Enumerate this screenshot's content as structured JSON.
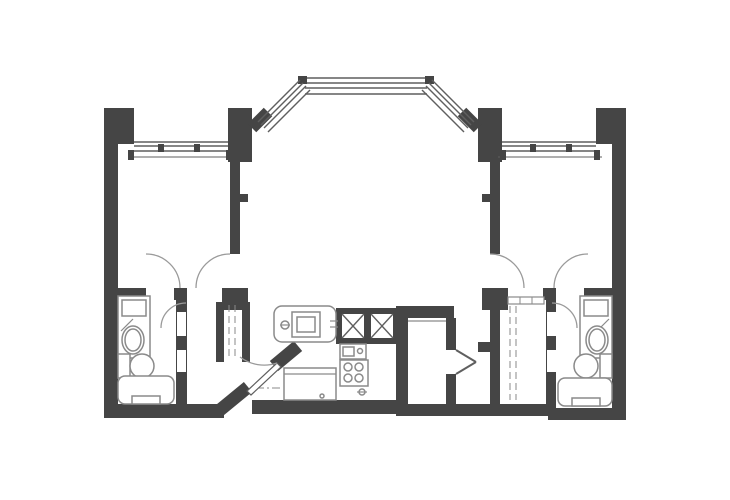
{
  "canvas": {
    "width": 730,
    "height": 500
  },
  "colors": {
    "wall": "#454545",
    "win": "#5f5f5f",
    "fix": "#8a8a8a",
    "arc": "#9a9a9a",
    "bg": "#ffffff"
  },
  "elements": [
    {
      "n": "left-outer-wall",
      "t": "w",
      "x": 104,
      "y": 108,
      "w": 14,
      "h": 310
    },
    {
      "n": "left-top-corner-block",
      "t": "w",
      "x": 104,
      "y": 108,
      "w": 30,
      "h": 34
    },
    {
      "n": "left-sill-stub",
      "t": "w",
      "x": 118,
      "y": 136,
      "w": 16,
      "h": 8
    },
    {
      "n": "bay-left-column",
      "t": "w",
      "x": 228,
      "y": 108,
      "w": 24,
      "h": 54
    },
    {
      "n": "bay-right-column",
      "t": "w",
      "x": 478,
      "y": 108,
      "w": 24,
      "h": 54
    },
    {
      "n": "right-sill-stub",
      "t": "w",
      "x": 596,
      "y": 136,
      "w": 16,
      "h": 8
    },
    {
      "n": "right-top-corner-block",
      "t": "w",
      "x": 596,
      "y": 108,
      "w": 30,
      "h": 34
    },
    {
      "n": "right-outer-wall",
      "t": "w",
      "x": 612,
      "y": 108,
      "w": 14,
      "h": 312
    },
    {
      "n": "left-divider-wall",
      "t": "w",
      "x": 230,
      "y": 162,
      "w": 10,
      "h": 92
    },
    {
      "n": "left-divider-stub",
      "t": "w",
      "x": 240,
      "y": 194,
      "w": 8,
      "h": 8
    },
    {
      "n": "right-divider-wall",
      "t": "w",
      "x": 490,
      "y": 162,
      "w": 10,
      "h": 92
    },
    {
      "n": "right-divider-stub",
      "t": "w",
      "x": 482,
      "y": 194,
      "w": 8,
      "h": 8
    },
    {
      "n": "left-bedroom-south-wall-west",
      "t": "w",
      "x": 118,
      "y": 288,
      "w": 28,
      "h": 12
    },
    {
      "n": "left-bedroom-south-wall-mid",
      "t": "w",
      "x": 174,
      "y": 288,
      "w": 13,
      "h": 12
    },
    {
      "n": "left-foyer-corner-block",
      "t": "w",
      "x": 222,
      "y": 288,
      "w": 26,
      "h": 22
    },
    {
      "n": "right-bedroom-south-wall-east",
      "t": "w",
      "x": 584,
      "y": 288,
      "w": 28,
      "h": 12
    },
    {
      "n": "right-bedroom-south-wall-mid",
      "t": "w",
      "x": 543,
      "y": 288,
      "w": 13,
      "h": 12
    },
    {
      "n": "right-foyer-corner-block",
      "t": "w",
      "x": 482,
      "y": 288,
      "w": 26,
      "h": 22
    },
    {
      "n": "left-bath-partition-wall",
      "t": "w",
      "x": 176,
      "y": 288,
      "w": 11,
      "h": 122
    },
    {
      "n": "left-bath-south-wall",
      "t": "w",
      "x": 104,
      "y": 404,
      "w": 86,
      "h": 14
    },
    {
      "n": "left-hall-south-wall",
      "t": "w",
      "x": 186,
      "y": 404,
      "w": 38,
      "h": 14
    },
    {
      "n": "left-closet-west-wall",
      "t": "w",
      "x": 216,
      "y": 302,
      "w": 8,
      "h": 60
    },
    {
      "n": "left-closet-east-wall",
      "t": "w",
      "x": 242,
      "y": 302,
      "w": 8,
      "h": 60
    },
    {
      "n": "shaft-enclosure",
      "t": "w",
      "x": 336,
      "y": 308,
      "w": 62,
      "h": 36
    },
    {
      "n": "kitchen-east-wall",
      "t": "w",
      "x": 396,
      "y": 306,
      "w": 12,
      "h": 108
    },
    {
      "n": "den-north-wall",
      "t": "w",
      "x": 408,
      "y": 306,
      "w": 46,
      "h": 12
    },
    {
      "n": "den-east-wall-upper",
      "t": "w",
      "x": 446,
      "y": 318,
      "w": 10,
      "h": 32
    },
    {
      "n": "den-east-wall-lower",
      "t": "w",
      "x": 446,
      "y": 374,
      "w": 10,
      "h": 40
    },
    {
      "n": "kitchen-south-wall",
      "t": "w",
      "x": 252,
      "y": 400,
      "w": 146,
      "h": 14
    },
    {
      "n": "center-south-wall",
      "t": "w",
      "x": 396,
      "y": 404,
      "w": 160,
      "h": 12
    },
    {
      "n": "right-closet-west-wall",
      "t": "w",
      "x": 490,
      "y": 310,
      "w": 10,
      "h": 94
    },
    {
      "n": "right-closet-west-stub",
      "t": "w",
      "x": 478,
      "y": 342,
      "w": 12,
      "h": 10
    },
    {
      "n": "right-bath-partition-wall",
      "t": "w",
      "x": 546,
      "y": 288,
      "w": 10,
      "h": 122
    },
    {
      "n": "right-bath-south-wall",
      "t": "w",
      "x": 548,
      "y": 408,
      "w": 78,
      "h": 12
    },
    {
      "n": "entry-diagonal-wall-lower",
      "t": "l",
      "x1": 220,
      "y1": 410,
      "x2": 248,
      "y2": 387,
      "c": "wall",
      "sw": 13
    },
    {
      "n": "entry-diagonal-wall-upper",
      "t": "l",
      "x1": 274,
      "y1": 366,
      "x2": 298,
      "y2": 346,
      "c": "wall",
      "sw": 13
    },
    {
      "n": "bay-left-wall-stub",
      "t": "l",
      "x1": 252,
      "y1": 128,
      "x2": 268,
      "y2": 112,
      "c": "wall",
      "sw": 12
    },
    {
      "n": "bay-right-wall-stub",
      "t": "l",
      "x1": 462,
      "y1": 112,
      "x2": 478,
      "y2": 128,
      "c": "wall",
      "sw": 12
    },
    {
      "n": "left-bath-door-jamb-upper",
      "t": "b",
      "x": 177,
      "y": 312,
      "w": 9,
      "h": 24
    },
    {
      "n": "left-bath-door-jamb-lower",
      "t": "b",
      "x": 177,
      "y": 350,
      "w": 9,
      "h": 22
    },
    {
      "n": "right-bath-door-jamb-upper",
      "t": "b",
      "x": 547,
      "y": 312,
      "w": 9,
      "h": 24
    },
    {
      "n": "right-bath-door-jamb-lower",
      "t": "b",
      "x": 547,
      "y": 350,
      "w": 9,
      "h": 22
    },
    {
      "n": "left-window-line-outer",
      "t": "l",
      "x1": 134,
      "y1": 142,
      "x2": 228,
      "y2": 142,
      "c": "win",
      "sw": 1.4
    },
    {
      "n": "left-window-line-mid",
      "t": "l",
      "x1": 134,
      "y1": 146,
      "x2": 228,
      "y2": 146,
      "c": "win",
      "sw": 1.4
    },
    {
      "n": "left-window-line-inner",
      "t": "l",
      "x1": 134,
      "y1": 151,
      "x2": 228,
      "y2": 151,
      "c": "win",
      "sw": 1.4
    },
    {
      "n": "left-window-sill",
      "t": "l",
      "x1": 128,
      "y1": 157,
      "x2": 232,
      "y2": 157,
      "c": "win",
      "sw": 1.1
    },
    {
      "n": "left-window-mullion-a",
      "t": "w",
      "x": 158,
      "y": 144,
      "w": 6,
      "h": 8
    },
    {
      "n": "left-window-mullion-b",
      "t": "w",
      "x": 194,
      "y": 144,
      "w": 6,
      "h": 8
    },
    {
      "n": "left-window-hook-west",
      "t": "w",
      "x": 128,
      "y": 150,
      "w": 6,
      "h": 10
    },
    {
      "n": "left-window-hook-east",
      "t": "w",
      "x": 226,
      "y": 150,
      "w": 6,
      "h": 10
    },
    {
      "n": "right-window-line-outer",
      "t": "l",
      "x1": 502,
      "y1": 142,
      "x2": 596,
      "y2": 142,
      "c": "win",
      "sw": 1.4
    },
    {
      "n": "right-window-line-mid",
      "t": "l",
      "x1": 502,
      "y1": 146,
      "x2": 596,
      "y2": 146,
      "c": "win",
      "sw": 1.4
    },
    {
      "n": "right-window-line-inner",
      "t": "l",
      "x1": 502,
      "y1": 151,
      "x2": 596,
      "y2": 151,
      "c": "win",
      "sw": 1.4
    },
    {
      "n": "right-window-sill",
      "t": "l",
      "x1": 498,
      "y1": 157,
      "x2": 602,
      "y2": 157,
      "c": "win",
      "sw": 1.1
    },
    {
      "n": "right-window-mullion-a",
      "t": "w",
      "x": 530,
      "y": 144,
      "w": 6,
      "h": 8
    },
    {
      "n": "right-window-mullion-b",
      "t": "w",
      "x": 566,
      "y": 144,
      "w": 6,
      "h": 8
    },
    {
      "n": "right-window-hook-west",
      "t": "w",
      "x": 500,
      "y": 150,
      "w": 6,
      "h": 10
    },
    {
      "n": "right-window-hook-east",
      "t": "w",
      "x": 594,
      "y": 150,
      "w": 6,
      "h": 10
    },
    {
      "n": "bay-top-window-line-1",
      "t": "l",
      "x1": 305,
      "y1": 78,
      "x2": 427,
      "y2": 78,
      "c": "win",
      "sw": 1.4
    },
    {
      "n": "bay-top-window-line-2",
      "t": "l",
      "x1": 305,
      "y1": 83,
      "x2": 427,
      "y2": 83,
      "c": "win",
      "sw": 1.4
    },
    {
      "n": "bay-top-window-line-3",
      "t": "l",
      "x1": 305,
      "y1": 88,
      "x2": 427,
      "y2": 88,
      "c": "win",
      "sw": 1.4
    },
    {
      "n": "bay-top-window-line-4",
      "t": "l",
      "x1": 305,
      "y1": 94,
      "x2": 427,
      "y2": 94,
      "c": "win",
      "sw": 1.4
    },
    {
      "n": "bay-mullion-left",
      "t": "w",
      "x": 298,
      "y": 76,
      "w": 9,
      "h": 8
    },
    {
      "n": "bay-mullion-right",
      "t": "w",
      "x": 425,
      "y": 76,
      "w": 9,
      "h": 8
    },
    {
      "n": "bay-left-window-line-1",
      "t": "l",
      "x1": 258,
      "y1": 122,
      "x2": 300,
      "y2": 80,
      "c": "win",
      "sw": 1.4
    },
    {
      "n": "bay-left-window-line-2",
      "t": "l",
      "x1": 261,
      "y1": 125,
      "x2": 303,
      "y2": 83,
      "c": "win",
      "sw": 1.4
    },
    {
      "n": "bay-left-window-line-3",
      "t": "l",
      "x1": 264,
      "y1": 128,
      "x2": 306,
      "y2": 86,
      "c": "win",
      "sw": 1.4
    },
    {
      "n": "bay-left-window-line-4",
      "t": "l",
      "x1": 268,
      "y1": 132,
      "x2": 310,
      "y2": 90,
      "c": "win",
      "sw": 1.4
    },
    {
      "n": "bay-right-window-line-1",
      "t": "l",
      "x1": 432,
      "y1": 80,
      "x2": 474,
      "y2": 122,
      "c": "win",
      "sw": 1.4
    },
    {
      "n": "bay-right-window-line-2",
      "t": "l",
      "x1": 429,
      "y1": 83,
      "x2": 471,
      "y2": 125,
      "c": "win",
      "sw": 1.4
    },
    {
      "n": "bay-right-window-line-3",
      "t": "l",
      "x1": 426,
      "y1": 86,
      "x2": 468,
      "y2": 128,
      "c": "win",
      "sw": 1.4
    },
    {
      "n": "bay-right-window-line-4",
      "t": "l",
      "x1": 422,
      "y1": 90,
      "x2": 464,
      "y2": 132,
      "c": "win",
      "sw": 1.4
    },
    {
      "n": "left-vanity-counter",
      "t": "o",
      "x": 118,
      "y": 296,
      "w": 32,
      "h": 62
    },
    {
      "n": "left-vanity-shelf",
      "t": "o",
      "x": 122,
      "y": 300,
      "w": 24,
      "h": 16
    },
    {
      "n": "left-vanity-hatch",
      "t": "l",
      "x1": 121,
      "y1": 331,
      "x2": 133,
      "y2": 319,
      "c": "fix",
      "sw": 1.2
    },
    {
      "n": "left-sink-outer",
      "t": "e",
      "cx": 133,
      "cy": 340,
      "rx": 11,
      "ry": 14
    },
    {
      "n": "left-sink-inner",
      "t": "e",
      "cx": 133,
      "cy": 340,
      "rx": 8,
      "ry": 11
    },
    {
      "n": "left-toilet-tank",
      "t": "o",
      "x": 118,
      "y": 354,
      "w": 12,
      "h": 24
    },
    {
      "n": "left-toilet-bowl",
      "t": "c",
      "cx": 142,
      "cy": 366,
      "r": 12
    },
    {
      "n": "left-bathtub",
      "t": "o",
      "x": 118,
      "y": 376,
      "w": 56,
      "h": 28,
      "rx": 7
    },
    {
      "n": "left-bathtub-detail",
      "t": "o",
      "x": 132,
      "y": 396,
      "w": 28,
      "h": 8
    },
    {
      "n": "right-vanity-counter",
      "t": "o",
      "x": 580,
      "y": 296,
      "w": 32,
      "h": 62
    },
    {
      "n": "right-vanity-shelf",
      "t": "o",
      "x": 584,
      "y": 300,
      "w": 24,
      "h": 16
    },
    {
      "n": "right-vanity-hatch",
      "t": "l",
      "x1": 597,
      "y1": 331,
      "x2": 609,
      "y2": 319,
      "c": "fix",
      "sw": 1.2
    },
    {
      "n": "right-sink-outer",
      "t": "e",
      "cx": 597,
      "cy": 340,
      "rx": 11,
      "ry": 14
    },
    {
      "n": "right-sink-inner",
      "t": "e",
      "cx": 597,
      "cy": 340,
      "rx": 8,
      "ry": 11
    },
    {
      "n": "right-toilet-tank",
      "t": "o",
      "x": 600,
      "y": 354,
      "w": 12,
      "h": 24
    },
    {
      "n": "right-toilet-bowl",
      "t": "c",
      "cx": 586,
      "cy": 366,
      "r": 12
    },
    {
      "n": "right-bathtub",
      "t": "o",
      "x": 558,
      "y": 378,
      "w": 54,
      "h": 28,
      "rx": 7
    },
    {
      "n": "right-bathtub-detail",
      "t": "o",
      "x": 572,
      "y": 398,
      "w": 28,
      "h": 8
    },
    {
      "n": "left-closet-rod-line-a",
      "t": "l",
      "x1": 229,
      "y1": 305,
      "x2": 229,
      "y2": 360,
      "c": "fix",
      "sw": 1,
      "dash": "7,4"
    },
    {
      "n": "left-closet-rod-line-b",
      "t": "l",
      "x1": 235,
      "y1": 305,
      "x2": 235,
      "y2": 360,
      "c": "fix",
      "sw": 1,
      "dash": "7,4"
    },
    {
      "n": "right-closet-rod-line-a",
      "t": "l",
      "x1": 510,
      "y1": 306,
      "x2": 510,
      "y2": 400,
      "c": "fix",
      "sw": 1,
      "dash": "7,4"
    },
    {
      "n": "right-closet-rod-line-b",
      "t": "l",
      "x1": 516,
      "y1": 306,
      "x2": 516,
      "y2": 400,
      "c": "fix",
      "sw": 1,
      "dash": "7,4"
    },
    {
      "n": "right-closet-door-track",
      "t": "o",
      "x": 508,
      "y": 297,
      "w": 36,
      "h": 7,
      "sw": 1.2
    },
    {
      "n": "right-closet-track-tick-a",
      "t": "l",
      "x1": 520,
      "y1": 297,
      "x2": 520,
      "y2": 304,
      "c": "fix",
      "sw": 1
    },
    {
      "n": "right-closet-track-tick-b",
      "t": "l",
      "x1": 532,
      "y1": 297,
      "x2": 532,
      "y2": 304,
      "c": "fix",
      "sw": 1
    },
    {
      "n": "kitchen-counter",
      "t": "o",
      "x": 274,
      "y": 306,
      "w": 62,
      "h": 36,
      "rx": 8
    },
    {
      "n": "oven-outer",
      "t": "o",
      "x": 292,
      "y": 312,
      "w": 28,
      "h": 25
    },
    {
      "n": "oven-inner",
      "t": "o",
      "x": 297,
      "y": 317,
      "w": 18,
      "h": 15
    },
    {
      "n": "counter-faucet-symbol",
      "t": "c",
      "cx": 285,
      "cy": 325,
      "r": 4
    },
    {
      "n": "counter-faucet-line",
      "t": "l",
      "x1": 280,
      "y1": 325,
      "x2": 290,
      "y2": 325,
      "c": "fix",
      "sw": 1.2
    },
    {
      "n": "counter-tick-a",
      "t": "l",
      "x1": 330,
      "y1": 321,
      "x2": 338,
      "y2": 321,
      "c": "fix",
      "sw": 1.2
    },
    {
      "n": "counter-tick-b",
      "t": "l",
      "x1": 330,
      "y1": 327,
      "x2": 338,
      "y2": 327,
      "c": "fix",
      "sw": 1.2
    },
    {
      "n": "shaft-a-cavity",
      "t": "b",
      "x": 342,
      "y": 314,
      "w": 22,
      "h": 24
    },
    {
      "n": "shaft-a-x1",
      "t": "l",
      "x1": 342,
      "y1": 314,
      "x2": 364,
      "y2": 338,
      "c": "win",
      "sw": 1.4
    },
    {
      "n": "shaft-a-x2",
      "t": "l",
      "x1": 364,
      "y1": 314,
      "x2": 342,
      "y2": 338,
      "c": "win",
      "sw": 1.4
    },
    {
      "n": "shaft-b-cavity",
      "t": "b",
      "x": 371,
      "y": 314,
      "w": 22,
      "h": 24
    },
    {
      "n": "shaft-b-x1",
      "t": "l",
      "x1": 371,
      "y1": 314,
      "x2": 393,
      "y2": 338,
      "c": "win",
      "sw": 1.4
    },
    {
      "n": "shaft-b-x2",
      "t": "l",
      "x1": 393,
      "y1": 314,
      "x2": 371,
      "y2": 338,
      "c": "win",
      "sw": 1.4
    },
    {
      "n": "kitchen-sink-unit",
      "t": "o",
      "x": 340,
      "y": 344,
      "w": 26,
      "h": 15
    },
    {
      "n": "kitchen-sink-bowl",
      "t": "o",
      "x": 343,
      "y": 347,
      "w": 11,
      "h": 9
    },
    {
      "n": "kitchen-sink-dot",
      "t": "c",
      "cx": 360,
      "cy": 351,
      "r": 2.5
    },
    {
      "n": "range",
      "t": "o",
      "x": 340,
      "y": 360,
      "w": 28,
      "h": 26
    },
    {
      "n": "burner-1",
      "t": "c",
      "cx": 348,
      "cy": 367,
      "r": 4
    },
    {
      "n": "burner-2",
      "t": "c",
      "cx": 359,
      "cy": 367,
      "r": 4
    },
    {
      "n": "burner-3",
      "t": "c",
      "cx": 348,
      "cy": 378,
      "r": 4
    },
    {
      "n": "burner-4",
      "t": "c",
      "cx": 359,
      "cy": 378,
      "r": 4
    },
    {
      "n": "range-valve",
      "t": "c",
      "cx": 362,
      "cy": 392,
      "r": 3
    },
    {
      "n": "range-valve-line",
      "t": "l",
      "x1": 357,
      "y1": 392,
      "x2": 367,
      "y2": 392,
      "c": "fix",
      "sw": 1.2
    },
    {
      "n": "fridge",
      "t": "o",
      "x": 284,
      "y": 368,
      "w": 52,
      "h": 32
    },
    {
      "n": "fridge-top-line",
      "t": "l",
      "x1": 284,
      "y1": 374,
      "x2": 336,
      "y2": 374,
      "c": "fix",
      "sw": 1.2
    },
    {
      "n": "fridge-handle-dot",
      "t": "c",
      "cx": 322,
      "cy": 396,
      "r": 2
    },
    {
      "n": "kitchen-soffit-dash",
      "t": "l",
      "x1": 256,
      "y1": 388,
      "x2": 282,
      "y2": 388,
      "c": "fix",
      "sw": 1,
      "dash": "8,3,2,3"
    },
    {
      "n": "den-north-inner-line",
      "t": "l",
      "x1": 408,
      "y1": 321,
      "x2": 446,
      "y2": 321,
      "c": "fix",
      "sw": 1.2
    },
    {
      "n": "den-double-door-leaf-a",
      "t": "l",
      "x1": 456,
      "y1": 350,
      "x2": 476,
      "y2": 362,
      "c": "win",
      "sw": 2
    },
    {
      "n": "den-double-door-leaf-b",
      "t": "l",
      "x1": 456,
      "y1": 374,
      "x2": 476,
      "y2": 362,
      "c": "win",
      "sw": 2
    },
    {
      "n": "entry-door-leaf",
      "t": "g",
      "pts": "247,391 277,363 281,367 251,395",
      "fill": "bg",
      "stroke": "win"
    },
    {
      "n": "entry-door-arc",
      "t": "p",
      "d": "M 277 363 A 40 40 0 0 1 240 357"
    },
    {
      "n": "left-bedroom-bath-door-arc",
      "t": "p",
      "d": "M 180 288 A 34 34 0 0 0 146 254"
    },
    {
      "n": "left-bedroom-entry-door-arc",
      "t": "p",
      "d": "M 196 288 A 34 34 0 0 1 230 254"
    },
    {
      "n": "right-bedroom-entry-door-arc",
      "t": "p",
      "d": "M 524 288 A 34 34 0 0 0 490 254"
    },
    {
      "n": "right-bedroom-bath-door-arc",
      "t": "p",
      "d": "M 554 288 A 34 34 0 0 1 588 254"
    },
    {
      "n": "left-bath-door-arc",
      "t": "p",
      "d": "M 186 303 A 25 25 0 0 0 161 328"
    },
    {
      "n": "right-bath-door-arc",
      "t": "p",
      "d": "M 552 303 A 25 25 0 0 1 577 328"
    }
  ]
}
